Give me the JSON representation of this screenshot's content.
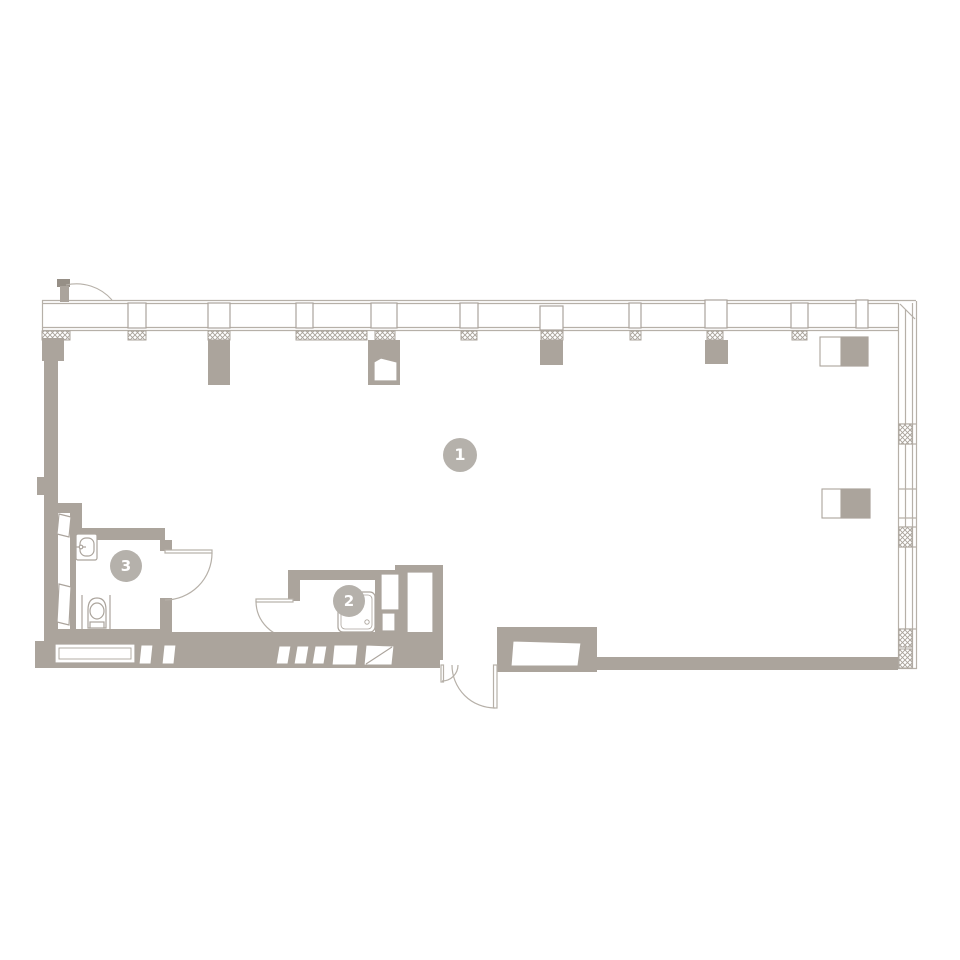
{
  "plan": {
    "type": "apartment-floor-plan",
    "badges": [
      {
        "id": "room-1",
        "label": "1"
      },
      {
        "id": "room-2",
        "label": "2"
      },
      {
        "id": "room-3",
        "label": "3"
      }
    ],
    "colors": {
      "wall": "#aba49c",
      "thin_line": "#b6b0a8",
      "hatch_line": "#a8a199",
      "badge_fill": "#b5b1ab",
      "badge_text": "#ffffff",
      "dark_accent": "#968f86",
      "background": "#ffffff"
    },
    "icons": [
      "window-wall-icon",
      "mullion-icon",
      "column-hatch-icon",
      "balcony-door-icon",
      "entrance-door-icon",
      "interior-door-icon",
      "toilet-icon",
      "sink-icon",
      "shower-tray-icon",
      "built-in-cabinet-icon",
      "radiator-icon"
    ]
  }
}
